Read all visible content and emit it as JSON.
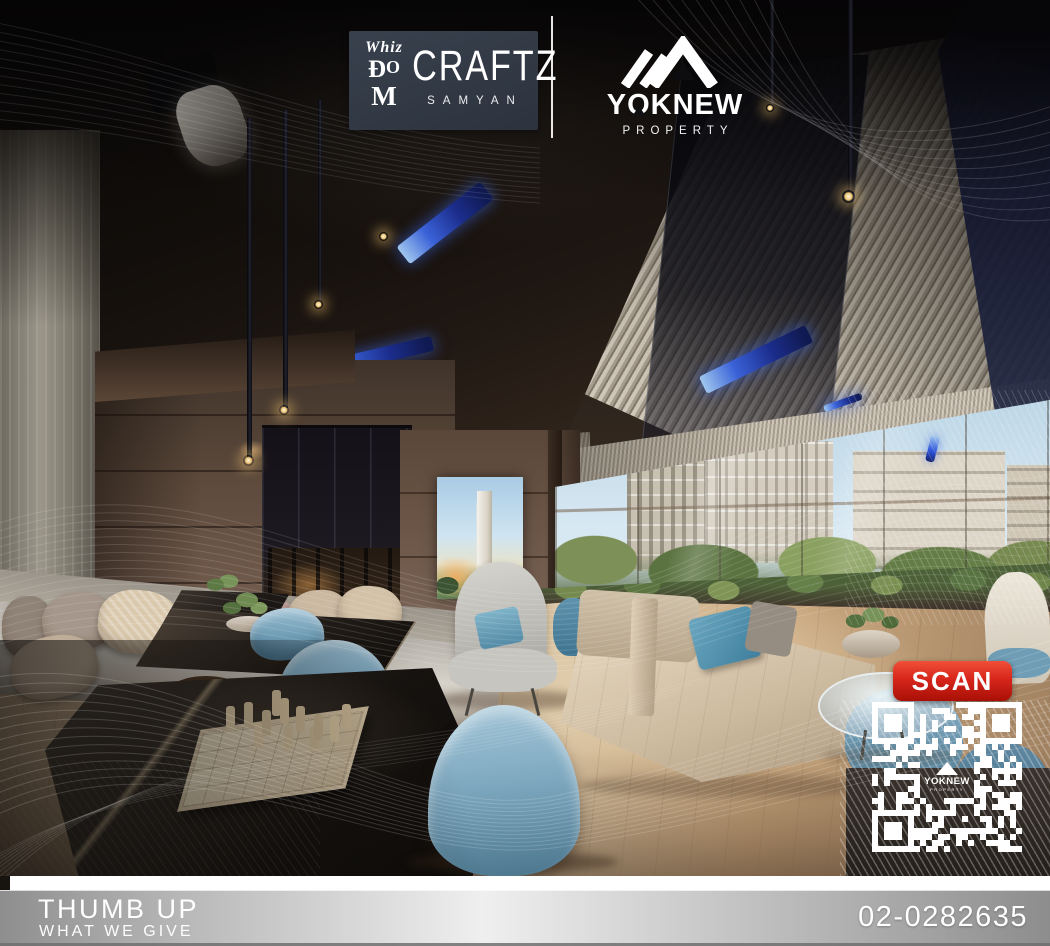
{
  "header": {
    "whizdom": {
      "whiz": "Whiz",
      "d": "Đ",
      "o": "O",
      "m": "M"
    },
    "project": {
      "name": "CRAFTZ",
      "subtitle": "SAMYAN"
    },
    "agency": {
      "name": "YOKNEW",
      "subtitle": "PROPERTY"
    }
  },
  "scan": {
    "label": "SCAN"
  },
  "footer": {
    "brand": "THUMB UP",
    "tagline": "WHAT WE GIVE",
    "phone": "02-0282635"
  },
  "colors": {
    "scan_red": "#d7261b",
    "led_blue": "#2b50d8",
    "logo_card_slate": "#323a46",
    "footer_silver": "#c9c9c9"
  }
}
